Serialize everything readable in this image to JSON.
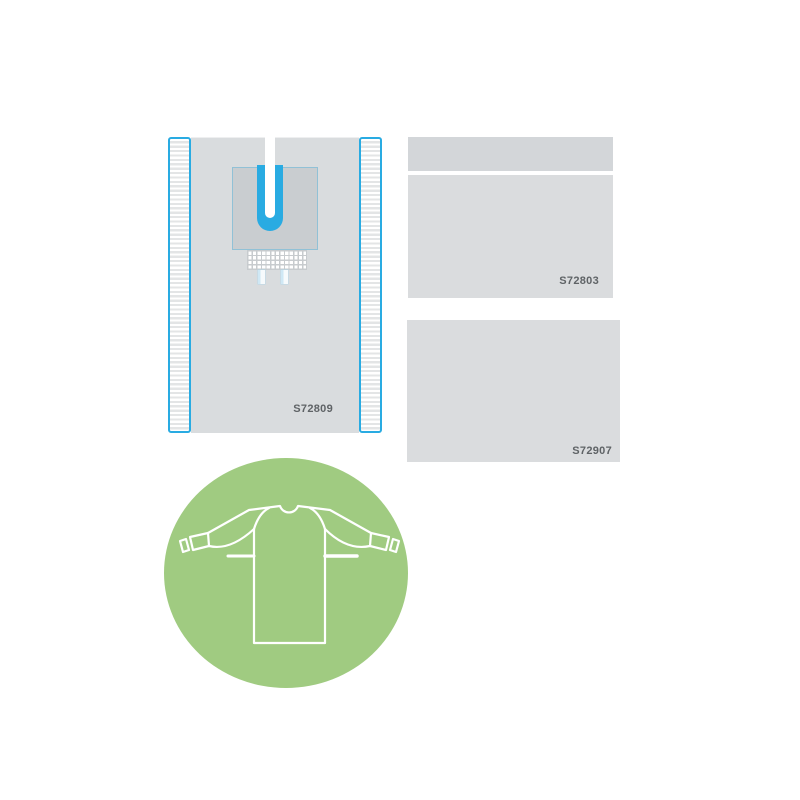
{
  "products": {
    "drape": {
      "code": "S72809"
    },
    "sheet_top": {
      "code": "S72803"
    },
    "sheet_bottom": {
      "code": "S72907"
    }
  },
  "badge": {
    "icon": "surgical-gown-icon"
  },
  "colors": {
    "accent_blue": "#29abe2",
    "panel_gray": "#d9dcde",
    "patch_gray": "#c9cdd0",
    "sheet_gray": "#dadcde",
    "sheet_strip_gray": "#d3d6d9",
    "label_text": "#5f6366",
    "badge_green": "#a0cb81",
    "gown_outline": "#ffffff"
  }
}
